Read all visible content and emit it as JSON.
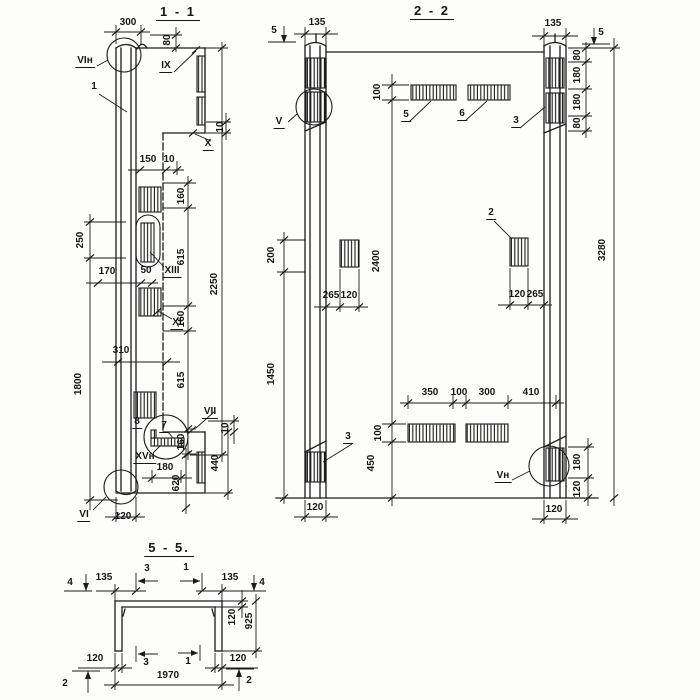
{
  "meta": {
    "paper_color": "#fdfdfc",
    "ink_color": "#1b1b1b"
  },
  "s11": {
    "title": "1 - 1",
    "marks": {
      "vi_top": "VIн",
      "ix": "IX",
      "x": "X",
      "xiii": "XIII",
      "xi": "XI",
      "vii": "VII",
      "xv": "XVн",
      "vi_bottom": "VI"
    },
    "items": {
      "i1": "1",
      "i7": "7",
      "i8": "8"
    },
    "dims": {
      "w300": "300",
      "h80": "80",
      "n10a": "10",
      "l150": "150",
      "n10b": "10",
      "v160a": "160",
      "v615a": "615",
      "v160b": "160",
      "v615b": "615",
      "v160c": "160",
      "total": "2250",
      "left250": "250",
      "left1800": "1800",
      "h170": "170",
      "h50": "50",
      "h310": "310",
      "n10c": "10",
      "b440": "440",
      "b180": "180",
      "b620": "620",
      "b120": "120"
    }
  },
  "s22": {
    "title": "2 - 2",
    "marks": {
      "v": "V",
      "vn": "Vн"
    },
    "items": {
      "i2": "2",
      "i3a": "3",
      "i3b": "3",
      "i5": "5",
      "i6": "6"
    },
    "cuts": {
      "left5": "5",
      "right5": "5"
    },
    "dims": {
      "t135l": "135",
      "t135r": "135",
      "r80a": "80",
      "r180a": "180",
      "r180b": "180",
      "r80b": "80",
      "total": "3280",
      "t100": "100",
      "l200": "200",
      "l1450": "1450",
      "m2400": "2400",
      "m265a": "265",
      "m120a": "120",
      "m120b": "120",
      "m265b": "265",
      "b350": "350",
      "b100": "100",
      "b300": "300",
      "b410": "410",
      "v100": "100",
      "v450": "450",
      "r180c": "180",
      "r120c": "120",
      "b120l": "120",
      "b120r": "120"
    }
  },
  "s55": {
    "title": "5 - 5.",
    "cuts": {
      "c4l": "4",
      "c4r": "4",
      "c3t": "3",
      "c1t": "1",
      "c3b": "3",
      "c1b": "1",
      "c2l": "2",
      "c2r": "2"
    },
    "dims": {
      "t135l": "135",
      "t135r": "135",
      "r120": "120",
      "r925": "925",
      "b120l": "120",
      "b120r": "120",
      "w1970": "1970"
    }
  }
}
